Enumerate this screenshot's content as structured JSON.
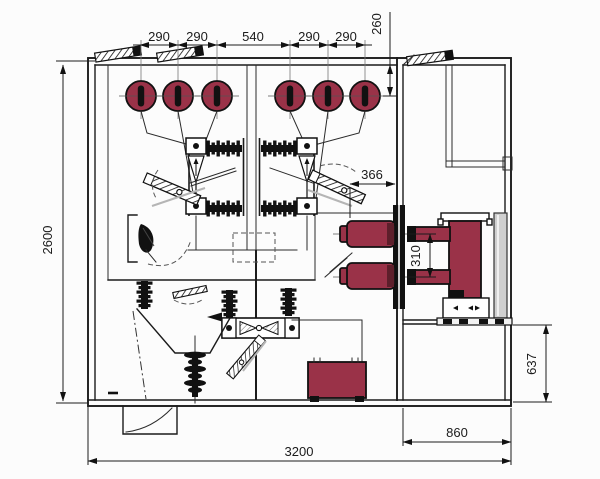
{
  "diagram": {
    "dimensions": {
      "top_chain": [
        "290",
        "290",
        "540",
        "290",
        "290"
      ],
      "top_depth": "260",
      "overall_height": "2600",
      "bushing_setback": "366",
      "contact_spacing": "310",
      "right_compartment_height": "637",
      "right_compartment_width": "860",
      "overall_width": "3200"
    },
    "colors": {
      "accent_maroon": "#9a3248",
      "accent_maroon_dark": "#5d1f2b",
      "line": "#1b1b1b",
      "ghost_gray": "#b5b5b5",
      "panel_gray": "#cfcfcf",
      "background": "#fcfcfc"
    }
  }
}
